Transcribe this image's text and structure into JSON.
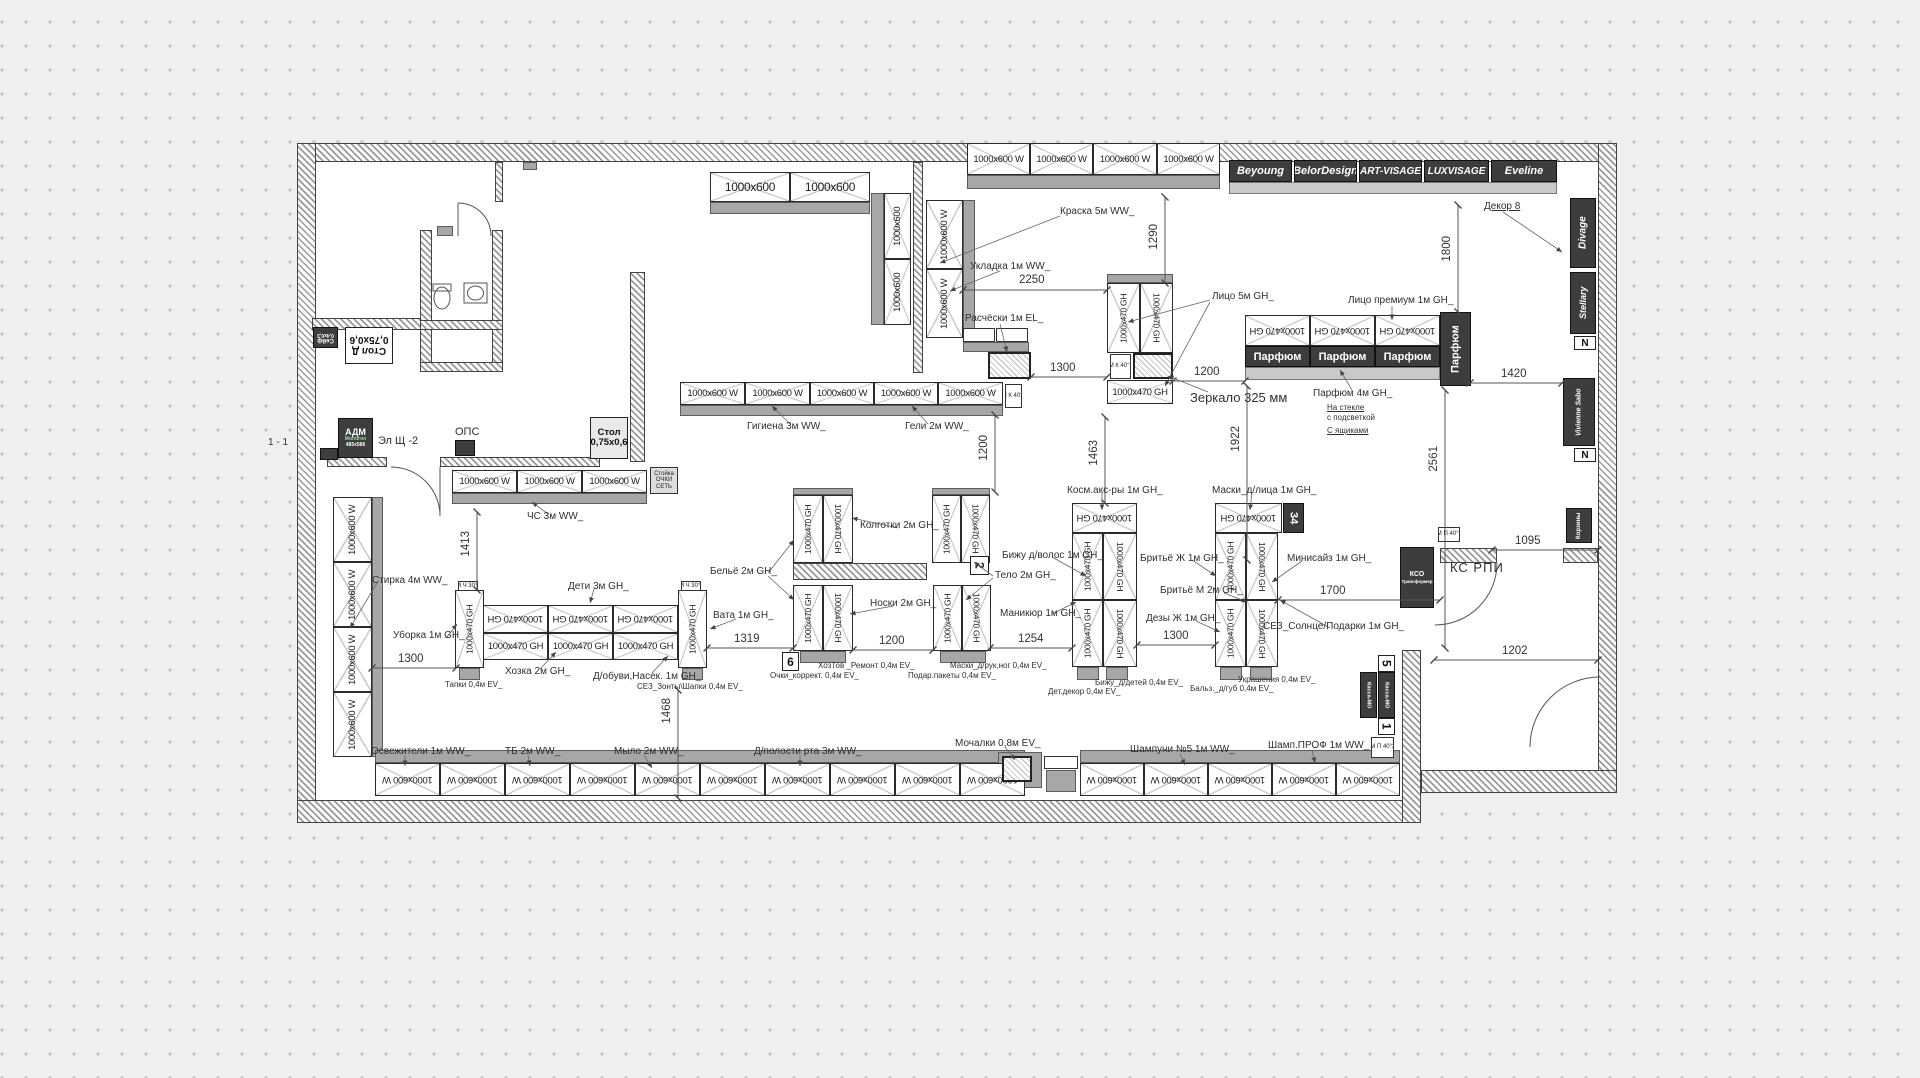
{
  "plan": {
    "sizes": {
      "s600": "1000x600",
      "s600w": "1000x600 W",
      "s470": "1000x470 GH"
    },
    "brands": {
      "beyoung": "Beyoung",
      "belordesign": "BelorDesign",
      "artvisage": "ART-VISAGE",
      "luxvisage": "LUXVISAGE",
      "eveline": "Eveline",
      "divage": "Divage",
      "stellary": "Stellary",
      "vivienne": "Vivienne Sabo"
    },
    "zones": {
      "kraska": "Краска 5м WW_",
      "ukladka": "Укладка 1м WW_",
      "rascheski": "Расчёски 1м EL_",
      "lico": "Лицо 5м GH_",
      "lico_premium": "Лицо премиум 1м GH_",
      "zerkalo": "Зеркало 325 мм",
      "parfum4": "Парфюм 4м GH_",
      "gigiena": "Гигиена 3м WW_",
      "geli": "Гели 2м WW_",
      "chs": "ЧС 3м WW_",
      "stirka": "Стирка 4м WW_",
      "uborka": "Уборка 1м GH_",
      "deti": "Дети 3м GH_",
      "hozka": "Хозка 2м GH_",
      "dobuvi": "Д/обуви,Насек. 1м GH_",
      "tapki": "Тапки 0,4м EV_",
      "sez_zonty": "СЕЗ_Зонты\\Шапки 0,4м EV_",
      "vata": "Вата 1м GH_",
      "belyo": "Бельё 2м GH_",
      "kolgotki": "Колготки 2м GH_",
      "noski": "Носки 2м GH_",
      "telo": "Тело 2м GH_",
      "bizhu_volos": "Бижу д/волос 1м GH_",
      "manikur": "Маникюр 1м GH_",
      "kosm_aks": "Косм.акс-ры 1м GH_",
      "maski_lica": "Маски_д/лица 1м GH_",
      "brityo_zh": "Бритьё Ж 1м GH_",
      "brityo_m": "Бритьё М 2м GH_",
      "dezy_zh": "Дезы Ж 1м GH_",
      "minisize": "Минисайз 1м GH_",
      "sez_solnce": "СЕЗ_Солнце/Подарки 1м GH_",
      "ochki": "Очки_коррект. 0,4м EV_",
      "hoztov": "ХозТов _Ремонт 0,4м EV_",
      "maski_ruk": "Маски_д/рук,ног 0,4м EV_",
      "podar": "Подар.пакеты 0,4м EV_",
      "bizhu_detey": "Бижу_д/детей 0,4м EV_",
      "det_dekor": "Дет.декор 0,4м EV_",
      "balz": "Бальз._д/губ 0,4м EV_",
      "ukrasheniya": "Украшения 0,4м EV_",
      "osvezhiteli": "Освежители 1м WW_",
      "tb": "ТБ 2м WW_",
      "mylo": "Мыло 2м WW_",
      "dpolosti": "Д/полости рта 3м WW_",
      "mochalki": "Мочалки 0,8м EV_",
      "shampuni": "Шампуни №5 1м WW_",
      "shamp_prof": "Шамп.ПРОФ 1м WW_"
    },
    "notes": {
      "parfum": "Парфюм",
      "dekor": "Декор 8",
      "na_stekle": "На стекле",
      "s_podsvetkoy": "с подсветкой",
      "s_yashchikami": "С ящиками",
      "korziny": "Корзины"
    },
    "rooms": {
      "ks_rpi": "КС РПИ",
      "el_shch": "Эл Щ -2",
      "ops": "ОПС",
      "section": "1 - 1"
    },
    "furniture": {
      "adm1": "АДМ",
      "adm2": "Monitron",
      "adm3": "485x586",
      "seyf1": "Сейф",
      "seyf2": "0,4х0,3",
      "stold1": "Стол Д",
      "stold2": "0,75х0,6",
      "stol1": "Стол",
      "stol2": "0,75х0,6",
      "stoyka1": "Стойка",
      "stoyka2": "ОЧКИ",
      "stoyka3": "СЕТЬ",
      "kso1": "КСО",
      "kso2": "Трансформер",
      "kassa": "Касса-МО"
    },
    "markers": {
      "m2": "2",
      "m6": "6",
      "m34": "34",
      "m5": "5",
      "m1": "1",
      "n": "N"
    },
    "tinyboxes": {
      "vmk4039": "ВМ К 40°39",
      "vmk4030": "ВМ К 40°30",
      "vmp4030": "ВМ П 40°30",
      "vmch3039": "ВМ Ч 30°39"
    },
    "dims": {
      "d2250": "2250",
      "d1290": "1290",
      "d1300": "1300",
      "d1200": "1200",
      "d1420": "1420",
      "d1800": "1800",
      "d1922": "1922",
      "d2561": "2561",
      "d1463": "1463",
      "d1095": "1095",
      "d1202": "1202",
      "d1413": "1413",
      "d1319": "1319",
      "d1254": "1254",
      "d1700": "1700",
      "d1468": "1468"
    }
  }
}
